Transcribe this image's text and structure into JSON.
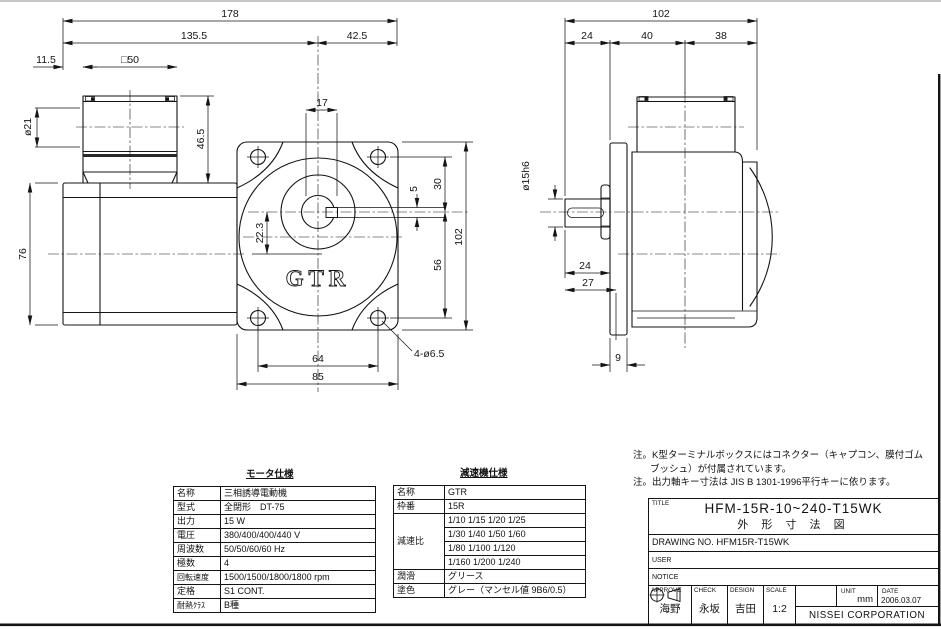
{
  "views": {
    "logo": "GTR",
    "front": {
      "overall_length": "178",
      "motor_side_length": "135.5",
      "gearhead_length": "42.5",
      "box_offset": "11.5",
      "box_width": "□50",
      "cable_dia": "ø21",
      "box_height": "46.5",
      "motor_height": "76",
      "boss_width": "17",
      "center_offset": "22.3",
      "key_width": "5",
      "shaft_to_top": "30",
      "shaft_to_bottom": "56",
      "flange_height": "102",
      "bolt_pitch": "64",
      "flange_width": "85",
      "mount_holes": "4-ø6.5"
    },
    "side": {
      "overall_depth": "102",
      "shaft_length_top": "24",
      "gear_depth": "40",
      "motor_depth": "38",
      "shaft_dia": "ø15h6",
      "shaft_length": "24",
      "register_depth": "27",
      "flange_thickness": "9"
    }
  },
  "motor_table": {
    "title": "モータ仕様",
    "rows": [
      {
        "label": "名称",
        "value": "三相誘導電動機"
      },
      {
        "label": "型式",
        "value": "全閉形　DT-75"
      },
      {
        "label": "出力",
        "value": "15 W"
      },
      {
        "label": "電圧",
        "value": "380/400/400/440 V"
      },
      {
        "label": "周波数",
        "value": "50/50/60/60 Hz"
      },
      {
        "label": "極数",
        "value": "4"
      },
      {
        "label": "回転速度",
        "value": "1500/1500/1800/1800 rpm"
      },
      {
        "label": "定格",
        "value": "S1 CONT."
      },
      {
        "label": "耐熱ｸﾗｽ",
        "value": "B種"
      }
    ]
  },
  "reducer_table": {
    "title": "減速機仕様",
    "name_label": "名称",
    "name": "GTR",
    "frame_label": "枠番",
    "frame": "15R",
    "ratio_label": "減速比",
    "ratios": [
      "1/10 1/15 1/20 1/25",
      "1/30 1/40 1/50 1/60",
      "1/80 1/100 1/120",
      "1/160 1/200 1/240"
    ],
    "lube_label": "潤滑",
    "lube": "グリース",
    "paint_label": "塗色",
    "paint": "グレー（マンセル値 9B6/0.5）"
  },
  "notes": {
    "line1": "注。K型ターミナルボックスにはコネクター（キャプコン、膜付ゴム",
    "line2": "ブッシュ）が付属されています。",
    "line3": "注。出力軸キー寸法は JIS B 1301-1996平行キーに依ります。"
  },
  "title_block": {
    "title_label": "TITLE",
    "title_line1": "HFM-15R-10~240-T15WK",
    "title_line2": "外 形 寸 法 図",
    "drawing_no_label": "DRAWING NO.",
    "drawing_no": "HFM15R-T15WK",
    "user_label": "USER",
    "notice_label": "NOTICE",
    "approve_label": "APPROVE",
    "approve": "海野",
    "check_label": "CHECK",
    "check": "永坂",
    "design_label": "DESIGN",
    "design": "吉田",
    "scale_label": "SCALE",
    "scale": "1:2",
    "unit_label": "UNIT",
    "unit": "mm",
    "date_label": "DATE",
    "date": "2006.03.07",
    "company": "NISSEI  CORPORATION"
  }
}
